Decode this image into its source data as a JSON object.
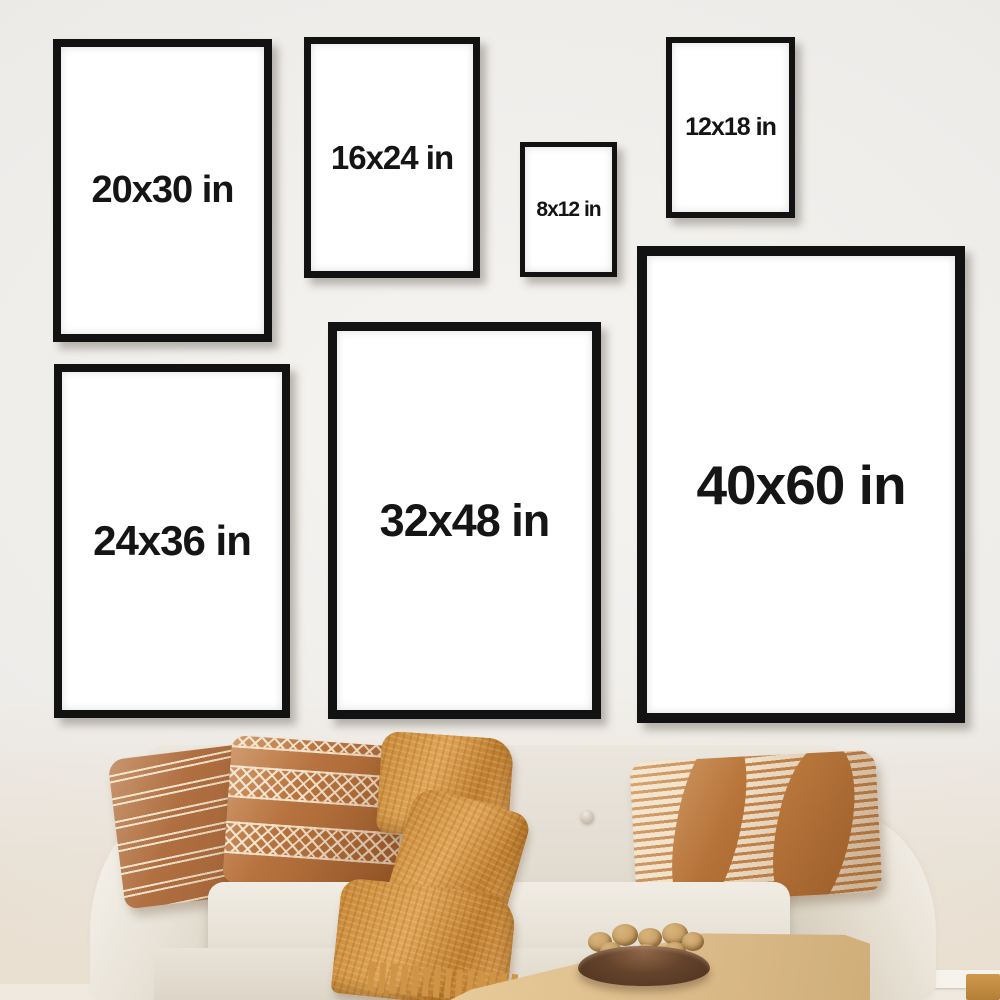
{
  "frames": [
    {
      "label": "20x30 in"
    },
    {
      "label": "16x24 in"
    },
    {
      "label": "8x12 in"
    },
    {
      "label": "12x18 in"
    },
    {
      "label": "24x36 in"
    },
    {
      "label": "32x48 in"
    },
    {
      "label": "40x60 in"
    }
  ],
  "colors": {
    "frame_border": "#121212",
    "poster": "#ffffff",
    "label_text": "#151515",
    "wall": "#edebe8",
    "sofa": "#eae5dc",
    "pillow_rust": "#b06f41",
    "pillow_cream": "#f0e1ca",
    "pillow_tan": "#c5854c",
    "blanket": "#d2964a",
    "table_wood": "#ddbd8c",
    "bowl": "#64432c",
    "nut": "#c9a267",
    "floor": "#efe9df",
    "baseboard": "#f6f3ed"
  }
}
